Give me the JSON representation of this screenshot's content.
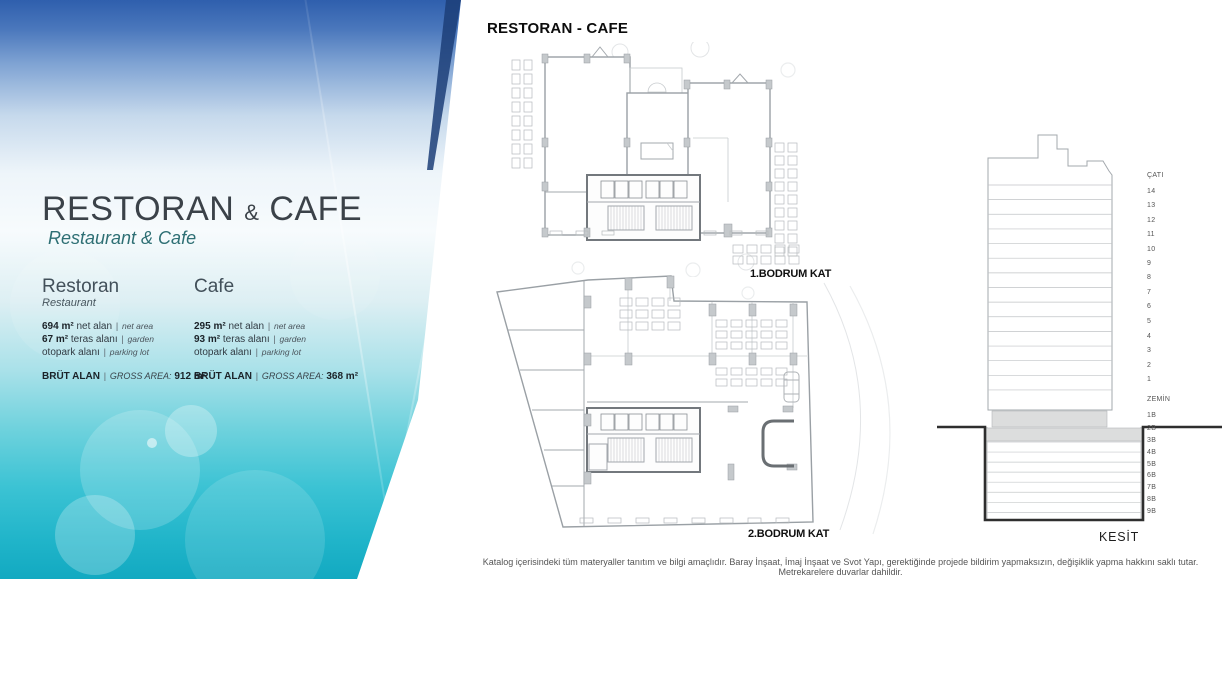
{
  "page": {
    "header_title": "RESTORAN - CAFE",
    "disclaimer": "Katalog içerisindeki tüm materyaller tanıtım ve bilgi amaçlıdır. Baray İnşaat, İmaj İnşaat ve Svot Yapı, gerektiğinde projede bildirim yapmaksızın, değişiklik yapma hakkını saklı tutar. Metrekarelere duvarlar dahildir."
  },
  "left_panel": {
    "title_main": "RESTORAN",
    "title_amp": "&",
    "title_end": "CAFE",
    "subtitle": "Restaurant & Cafe",
    "sep": "|",
    "columns": [
      {
        "heading_tr": "Restoran",
        "heading_en": "Restaurant",
        "rows": [
          {
            "value": "694 m²",
            "label_tr": "net alan",
            "label_en": "net area"
          },
          {
            "value": "67 m²",
            "label_tr": "teras alanı",
            "label_en": "garden"
          },
          {
            "value": "",
            "label_tr": "otopark alanı",
            "label_en": "parking lot"
          }
        ],
        "gross_label_tr": "BRÜT ALAN",
        "gross_label_en": "GROSS AREA:",
        "gross_value": "912 m²"
      },
      {
        "heading_tr": "Cafe",
        "heading_en": "",
        "rows": [
          {
            "value": "295 m²",
            "label_tr": "net alan",
            "label_en": "net area"
          },
          {
            "value": "93 m²",
            "label_tr": "teras alanı",
            "label_en": "garden"
          },
          {
            "value": "",
            "label_tr": "otopark alanı",
            "label_en": "parking lot"
          }
        ],
        "gross_label_tr": "BRÜT ALAN",
        "gross_label_en": "GROSS AREA:",
        "gross_value": "368 m²"
      }
    ]
  },
  "plans": [
    {
      "label": "1.BODRUM KAT"
    },
    {
      "label": "2.BODRUM KAT"
    }
  ],
  "section": {
    "label": "KESİT",
    "floors_above": [
      "ÇATI",
      "14",
      "13",
      "12",
      "11",
      "10",
      "9",
      "8",
      "7",
      "6",
      "5",
      "4",
      "3",
      "2",
      "1",
      "ZEMİN",
      "1B"
    ],
    "floors_below": [
      "2B",
      "3B",
      "4B",
      "5B",
      "6B",
      "7B",
      "8B",
      "9B"
    ]
  },
  "colors": {
    "panel_top_blue": "#2f5fad",
    "panel_bottom_teal": "#12a9c1",
    "subtitle_teal": "#2e6f74",
    "title_gray": "#3b4249"
  }
}
